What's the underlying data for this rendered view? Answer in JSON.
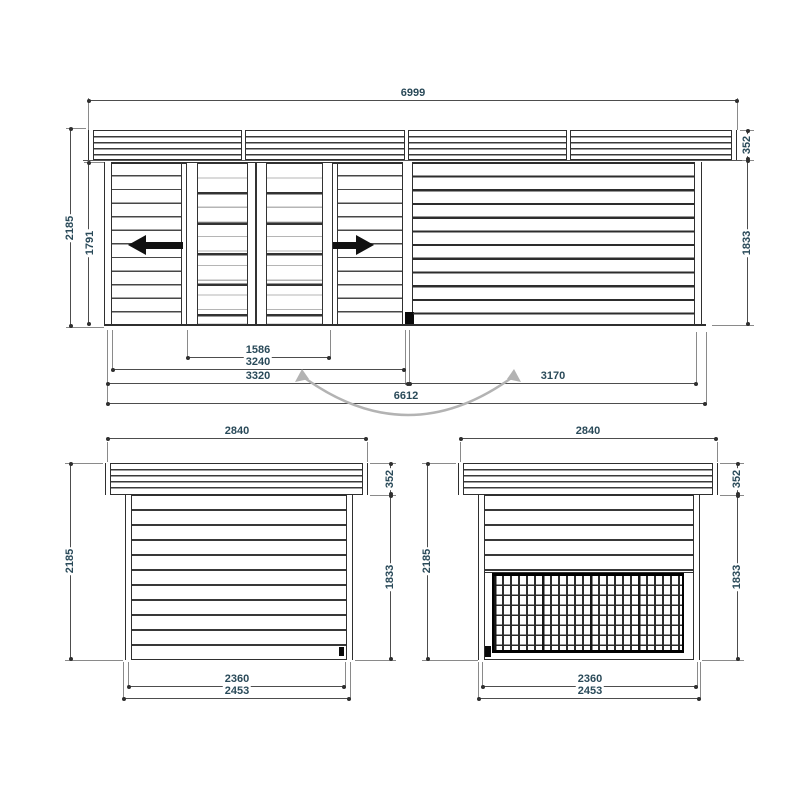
{
  "colors": {
    "background": "#ffffff",
    "drawing_line": "#2f2f2f",
    "dimension_line": "#4d4d4d",
    "dimension_text": "#2a4a59",
    "swing_arc": "#b3b3b3",
    "arrow": "#111111"
  },
  "front": {
    "dims": {
      "roof_width": "6999",
      "overall_height": "2185",
      "door_height": "1791",
      "fascia_height": "352",
      "wall_height": "1833",
      "door_opening_width": "1586",
      "cabin_inner_width": "3240",
      "cabin_width": "3320",
      "canopy_width": "3170",
      "base_width": "6612"
    }
  },
  "side_left": {
    "dims": {
      "roof_width": "2840",
      "overall_height": "2185",
      "fascia_height": "352",
      "wall_height": "1833",
      "inner_width": "2360",
      "base_width": "2453"
    }
  },
  "side_right": {
    "dims": {
      "roof_width": "2840",
      "overall_height": "2185",
      "fascia_height": "352",
      "wall_height": "1833",
      "inner_width": "2360",
      "base_width": "2453"
    }
  }
}
